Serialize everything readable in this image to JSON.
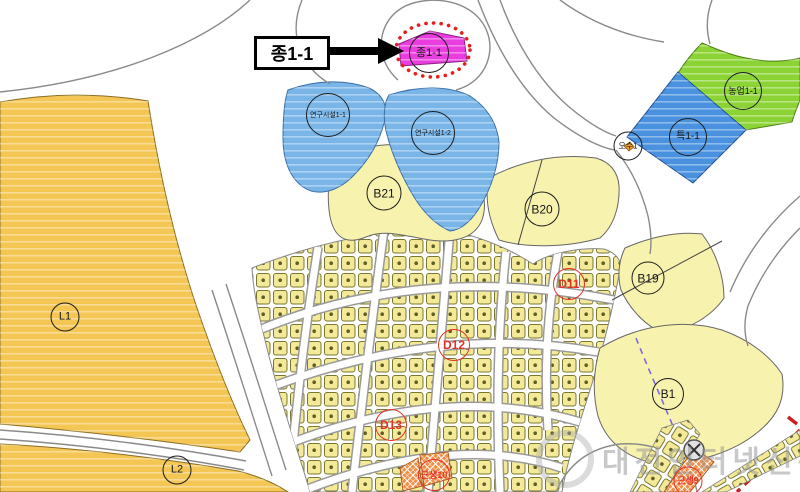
{
  "callout": {
    "label": "종1-1"
  },
  "watermark": {
    "text": "대전인터넷신문"
  },
  "zones": [
    {
      "id": "jong1-1",
      "label": "종1-1",
      "color": "#EA3DDF"
    },
    {
      "id": "yeongu1-1",
      "label": "연구시설1-1",
      "color": "#7AB5E8"
    },
    {
      "id": "yeongu1-2",
      "label": "연구시설1-2",
      "color": "#7AB5E8"
    },
    {
      "id": "nongeop1-1",
      "label": "농업1-1",
      "color": "#8CD435"
    },
    {
      "id": "teuk1-1",
      "label": "특1-1",
      "color": "#4A92DF"
    },
    {
      "id": "osu1",
      "label": "오수1",
      "color": "#FFFFFF"
    },
    {
      "id": "b21",
      "label": "B21",
      "color": "#F7F2AE"
    },
    {
      "id": "b20",
      "label": "B20",
      "color": "#F7F2AE"
    },
    {
      "id": "b19",
      "label": "B19",
      "color": "#F7F2AE"
    },
    {
      "id": "b1",
      "label": "B1",
      "color": "#F7F2AE"
    },
    {
      "id": "l1",
      "label": "L1",
      "color": "#F4C654"
    },
    {
      "id": "l2",
      "label": "L2",
      "color": "#F4C654"
    },
    {
      "id": "d11",
      "label": "D11",
      "color": "#E5312B"
    },
    {
      "id": "d12",
      "label": "D12",
      "color": "#E5312B"
    },
    {
      "id": "d13",
      "label": "D13",
      "color": "#E5312B"
    },
    {
      "id": "geunsaeng10",
      "label": "근생10",
      "color": "#EF8E45"
    },
    {
      "id": "geunsaeng9",
      "label": "근생9",
      "color": "#EF8E45"
    }
  ],
  "colors": {
    "zone_magenta": "#EA3DDF",
    "zone_research_blue": "#7AB5E8",
    "zone_special_blue": "#4A92DF",
    "zone_agriculture_green": "#8CD435",
    "zone_commercial_yellow": "#F7F2AE",
    "zone_landscape_orange": "#F4C654",
    "parcel_yellow": "#F3E998",
    "hatch_orange": "#EF8E45",
    "marker_red": "#E5312B",
    "highlight_dotted_red": "#E81C1C",
    "road_gray": "#8A8A8A",
    "boundary_dashed_purple": "#7B6BD8",
    "watermark_gray": "#BEBEBE"
  }
}
